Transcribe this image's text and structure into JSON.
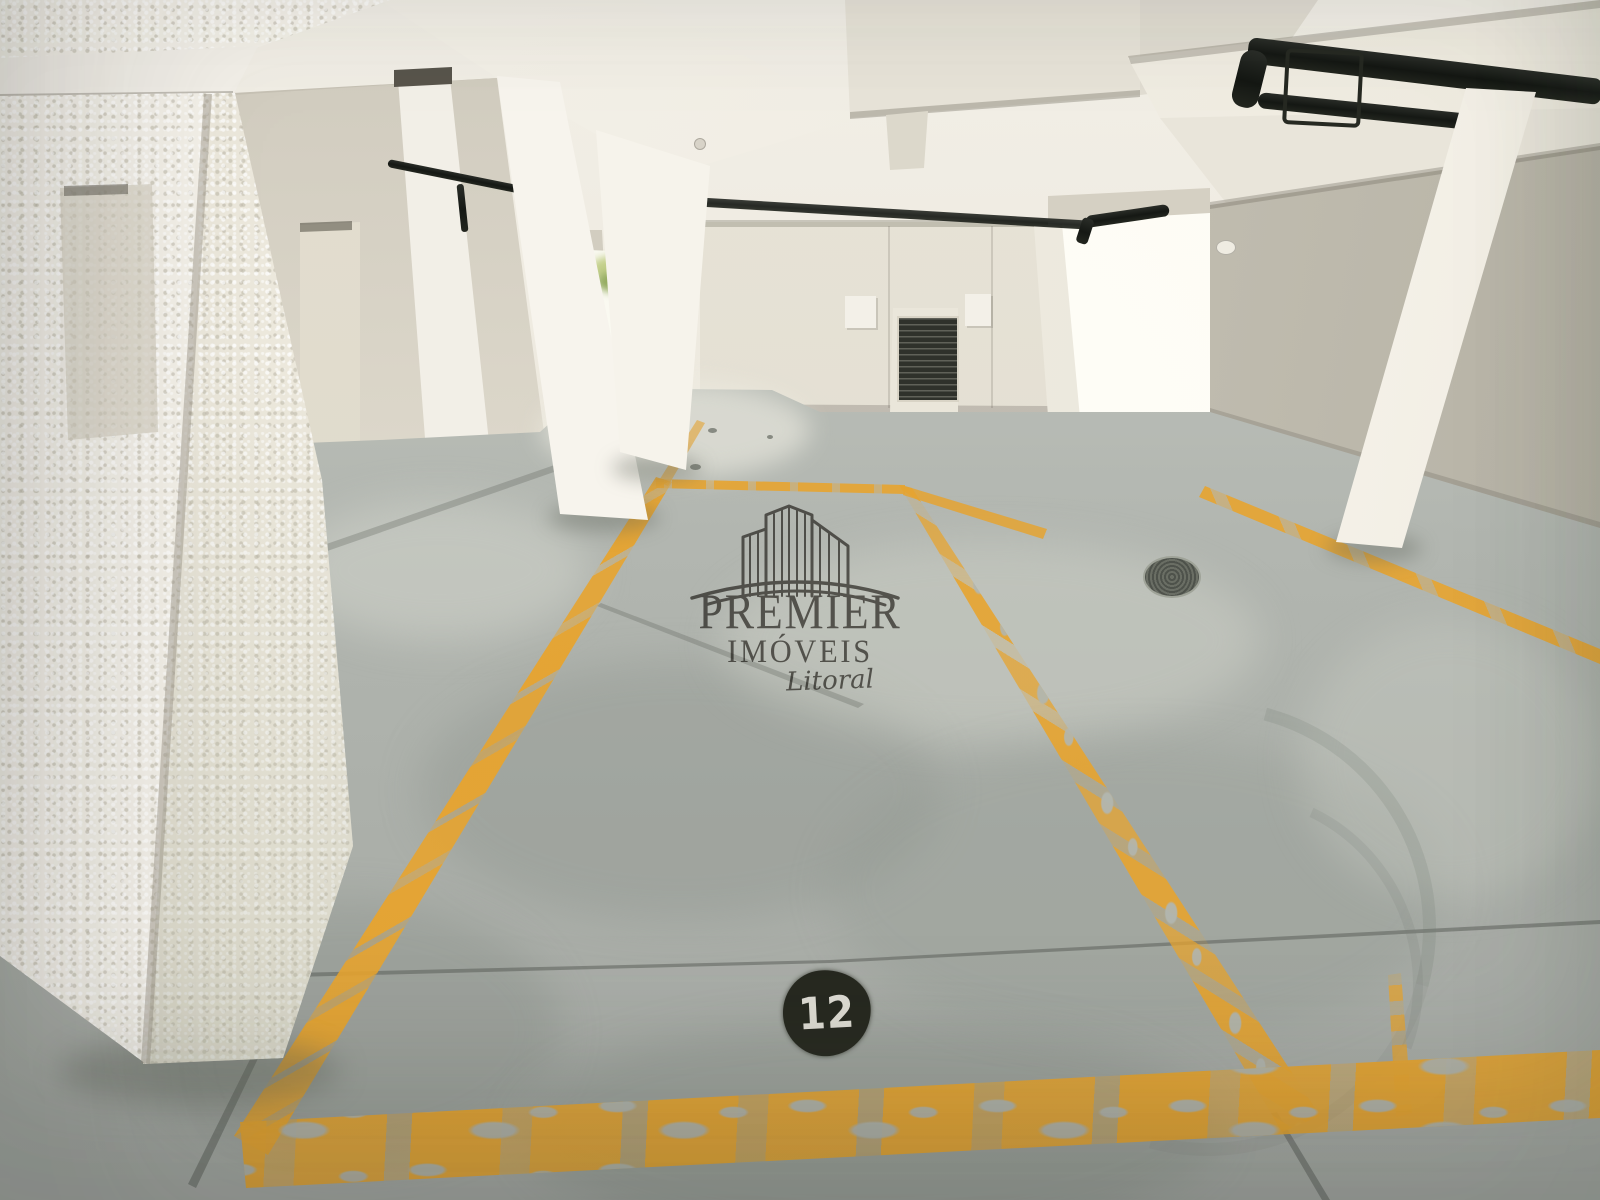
{
  "photo": {
    "description": "Empty underground residential parking garage, white concrete pillars and beams, gray concrete floor with yellow-painted parking space lines",
    "watermark": {
      "logo": "buildings-logo-icon",
      "line1": "PREMIER",
      "line2": "IMÓVEIS",
      "line3": "Litoral",
      "ink_color": "#4b4742"
    },
    "parking_spot": {
      "number": "12",
      "marker_background": "#26281f",
      "marker_text_color": "#dedcd3",
      "line_color": "#e7a42f"
    },
    "scene_elements": [
      "ceiling-beams",
      "stucco-pillar",
      "concrete-pillars",
      "ventilation-grille",
      "black-gas-pipes",
      "bright-doorway",
      "garden-opening",
      "floor-drain",
      "floor-seams",
      "tire-marks",
      "worn-yellow-lines"
    ],
    "palette": {
      "structure_white": "#f2efe7",
      "ceiling_shadow": "#c7c2b5",
      "wall": "#e7e3d7",
      "floor_far": "#c7cac2",
      "floor_near": "#a7aba6",
      "pipe_black": "#20231f"
    }
  }
}
